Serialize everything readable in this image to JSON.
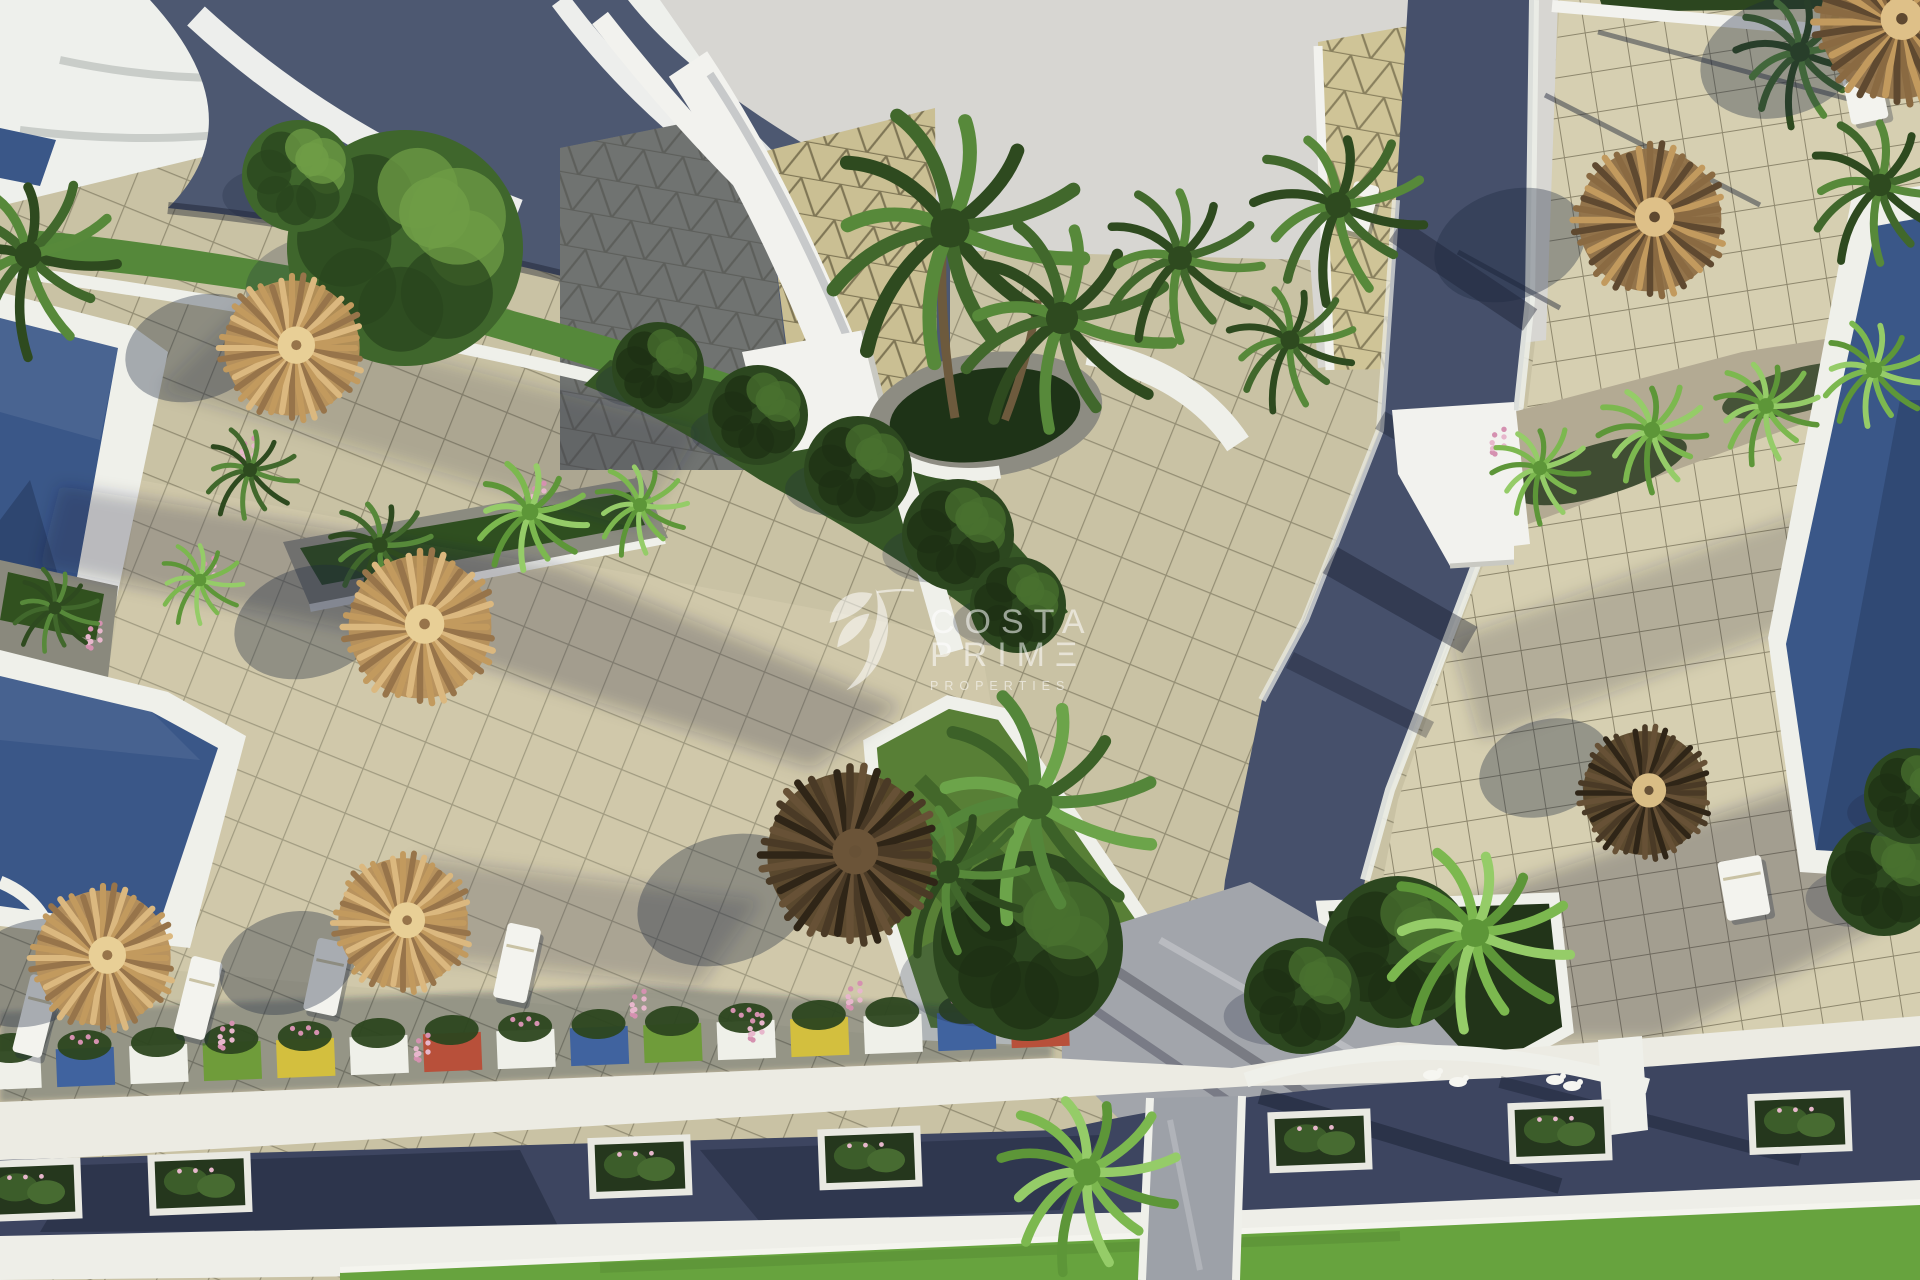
{
  "watermark": {
    "line1": "COSTA",
    "line2": "PRIMΞ",
    "line3": "PROPERTIES",
    "logo": "hummingbird-leaf-mark",
    "color": "#ffffff"
  },
  "palette": {
    "sky": "#d7d6d2",
    "white": "#f1f1ec",
    "tile_plaza": "#c9c2a4",
    "tile_terrace": "#d6cfb1",
    "tile_grid_line": "#46422c",
    "triangle_roof": "#cabf93",
    "dark_roof": "#4d5871",
    "road": "#46506b",
    "street": "#3d4560",
    "path_light": "#a2a5ab",
    "pool": "#3a5788",
    "grass": "#55883a",
    "lawn": "#67a33e",
    "hedge": "#2c461f",
    "stone": "#8b8b80",
    "gravel": "#b3aa93",
    "umbrella_tan": "#c29a5e",
    "umbrella_dark": "#54422c",
    "flower_pink": "#d591b0",
    "shadow": "rgba(30,40,62,0.35)"
  },
  "scene": {
    "umbrellas": [
      {
        "x": 292,
        "y": 348,
        "r": 72,
        "tone": "tan",
        "sdx": -95,
        "sdy": 0
      },
      {
        "x": 420,
        "y": 627,
        "r": 76,
        "tone": "tan",
        "sdx": -110,
        "sdy": -5
      },
      {
        "x": 103,
        "y": 958,
        "r": 72,
        "tone": "tan",
        "sdx": -70,
        "sdy": 15
      },
      {
        "x": 403,
        "y": 923,
        "r": 69,
        "tone": "tan",
        "sdx": -115,
        "sdy": 40
      },
      {
        "x": 850,
        "y": 855,
        "r": 88,
        "tone": "dark",
        "sdx": -125,
        "sdy": 45
      },
      {
        "x": 1650,
        "y": 220,
        "r": 76,
        "tone": "tan2",
        "sdx": -140,
        "sdy": 25
      },
      {
        "x": 1645,
        "y": 793,
        "r": 66,
        "tone": "dark2",
        "sdx": -100,
        "sdy": -25
      },
      {
        "x": 1897,
        "y": 22,
        "r": 82,
        "tone": "tan2",
        "sdx": -115,
        "sdy": 35
      }
    ],
    "palms": [
      {
        "x": 950,
        "y": 228,
        "r": 140,
        "tone": "dark"
      },
      {
        "x": 1062,
        "y": 318,
        "r": 115,
        "tone": "dark"
      },
      {
        "x": 1180,
        "y": 258,
        "r": 85,
        "tone": "dark"
      },
      {
        "x": 28,
        "y": 255,
        "r": 95,
        "tone": "dark"
      },
      {
        "x": 1338,
        "y": 205,
        "r": 92,
        "tone": "dark"
      },
      {
        "x": 1290,
        "y": 340,
        "r": 68,
        "tone": "dark"
      },
      {
        "x": 1800,
        "y": 52,
        "r": 70,
        "tone": "dark"
      },
      {
        "x": 1880,
        "y": 185,
        "r": 80,
        "tone": "dark"
      },
      {
        "x": 1035,
        "y": 802,
        "r": 125,
        "tone": "mid"
      },
      {
        "x": 948,
        "y": 872,
        "r": 82,
        "tone": "dark"
      },
      {
        "x": 1087,
        "y": 1172,
        "r": 96,
        "tone": "light"
      },
      {
        "x": 1475,
        "y": 933,
        "r": 100,
        "tone": "light"
      },
      {
        "x": 250,
        "y": 470,
        "r": 50,
        "tone": "dark"
      },
      {
        "x": 380,
        "y": 545,
        "r": 55,
        "tone": "dark"
      },
      {
        "x": 530,
        "y": 512,
        "r": 60,
        "tone": "light"
      },
      {
        "x": 640,
        "y": 505,
        "r": 50,
        "tone": "light"
      },
      {
        "x": 200,
        "y": 580,
        "r": 45,
        "tone": "light"
      },
      {
        "x": 55,
        "y": 608,
        "r": 46,
        "tone": "dark"
      },
      {
        "x": 1540,
        "y": 468,
        "r": 52,
        "tone": "light"
      },
      {
        "x": 1652,
        "y": 430,
        "r": 58,
        "tone": "light"
      },
      {
        "x": 1766,
        "y": 406,
        "r": 56,
        "tone": "light"
      },
      {
        "x": 1874,
        "y": 370,
        "r": 58,
        "tone": "light"
      }
    ],
    "trees": [
      {
        "x": 405,
        "y": 248,
        "r": 118,
        "tone": "mid"
      },
      {
        "x": 298,
        "y": 176,
        "r": 56,
        "tone": "mid"
      },
      {
        "x": 1028,
        "y": 946,
        "r": 95,
        "tone": "dark"
      },
      {
        "x": 1398,
        "y": 952,
        "r": 76,
        "tone": "dark"
      },
      {
        "x": 1302,
        "y": 996,
        "r": 58,
        "tone": "dark"
      },
      {
        "x": 658,
        "y": 368,
        "r": 46,
        "tone": "dark"
      },
      {
        "x": 758,
        "y": 415,
        "r": 50,
        "tone": "dark"
      },
      {
        "x": 858,
        "y": 470,
        "r": 54,
        "tone": "dark"
      },
      {
        "x": 958,
        "y": 535,
        "r": 56,
        "tone": "dark"
      },
      {
        "x": 1018,
        "y": 605,
        "r": 48,
        "tone": "dark"
      },
      {
        "x": 1884,
        "y": 878,
        "r": 58,
        "tone": "dark"
      },
      {
        "x": 1912,
        "y": 796,
        "r": 48,
        "tone": "dark"
      }
    ],
    "chairs": [
      {
        "x": 21,
        "y": 976,
        "w": 30,
        "h": 80,
        "rot": 14
      },
      {
        "x": 182,
        "y": 958,
        "w": 32,
        "h": 80,
        "rot": 14
      },
      {
        "x": 310,
        "y": 940,
        "w": 34,
        "h": 74,
        "rot": 12
      },
      {
        "x": 500,
        "y": 925,
        "w": 34,
        "h": 76,
        "rot": 12
      },
      {
        "x": 1722,
        "y": 858,
        "w": 44,
        "h": 60,
        "rot": -10
      },
      {
        "x": 1348,
        "y": 183,
        "w": 26,
        "h": 50,
        "rot": 15
      },
      {
        "x": 1845,
        "y": 60,
        "w": 38,
        "h": 62,
        "rot": -12
      }
    ],
    "flowers": [
      [
        210,
        575
      ],
      [
        250,
        455
      ],
      [
        96,
        640
      ],
      [
        640,
        1008
      ],
      [
        758,
        1032
      ],
      [
        856,
        1000
      ],
      [
        228,
        1040
      ],
      [
        424,
        1052
      ],
      [
        1500,
        446
      ],
      [
        540,
        500
      ]
    ],
    "figurines": [
      [
        1432,
        1075
      ],
      [
        1458,
        1082
      ],
      [
        1555,
        1080
      ],
      [
        1572,
        1086
      ]
    ],
    "planter_row1": {
      "x0": 12,
      "y0": 1070,
      "x1": 1040,
      "y1": 1028,
      "count": 15,
      "colors": [
        "#eff0e9",
        "#40639f",
        "#eff0e9",
        "#6f9c3a",
        "#d3bf3e",
        "#eff0e9",
        "#b8503a",
        "#eff0e9",
        "#40639f",
        "#6f9c3a",
        "#eff0e9",
        "#d3bf3e",
        "#eff0e9",
        "#40639f",
        "#b8503a"
      ]
    },
    "planter_row2": {
      "xs": [
        30,
        200,
        640,
        870,
        1320,
        1560,
        1800
      ],
      "y0": 1192,
      "slope": -0.038
    },
    "shadow_lines": [
      [
        1598,
        32,
        1882,
        108
      ],
      [
        1458,
        252,
        1560,
        308
      ],
      [
        1545,
        95,
        1760,
        205
      ]
    ]
  }
}
